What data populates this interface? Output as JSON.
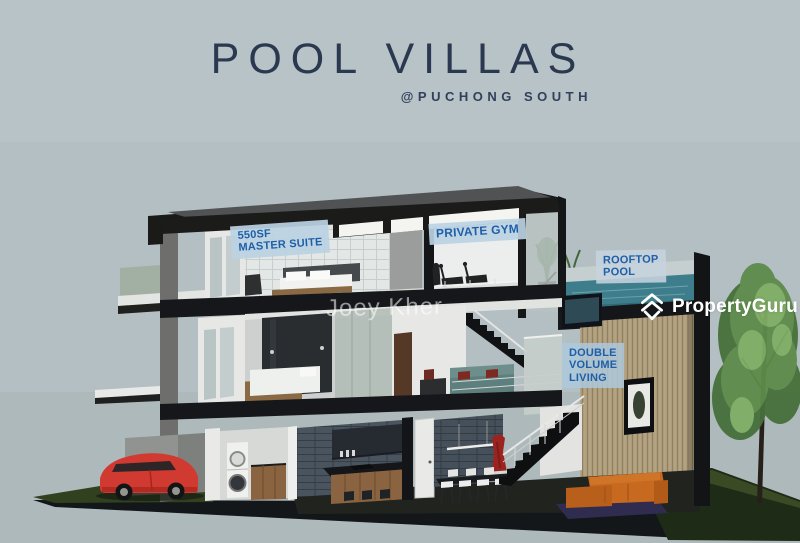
{
  "title": {
    "main": "POOL VILLAS",
    "subtitle": "@PUCHONG SOUTH"
  },
  "annotations": {
    "master_suite": {
      "line1": "550SF",
      "line2": "MASTER SUITE"
    },
    "private_gym": {
      "label": "PRIVATE GYM"
    },
    "rooftop_pool": {
      "line1": "ROOFTOP",
      "line2": "POOL"
    },
    "double_volume_living": {
      "line1": "DOUBLE",
      "line2": "VOLUME",
      "line3": "LIVING"
    }
  },
  "watermarks": {
    "agent_name": "Joey Kher",
    "brand_name": "PropertyGuru",
    "brand_logo_icon": "propertyguru-house-chevrons-icon"
  },
  "colors": {
    "background": "#b3bfc2",
    "title_navy": "#2b3950",
    "label_text_blue": "#1f5fa8",
    "label_background": "#bcd2e3",
    "pool_teal": "#3e7e8c",
    "car_red": "#d13a30",
    "sofa_orange": "#c76a1f",
    "grass_green": "#31401f",
    "watermark_white": "#ffffff"
  }
}
